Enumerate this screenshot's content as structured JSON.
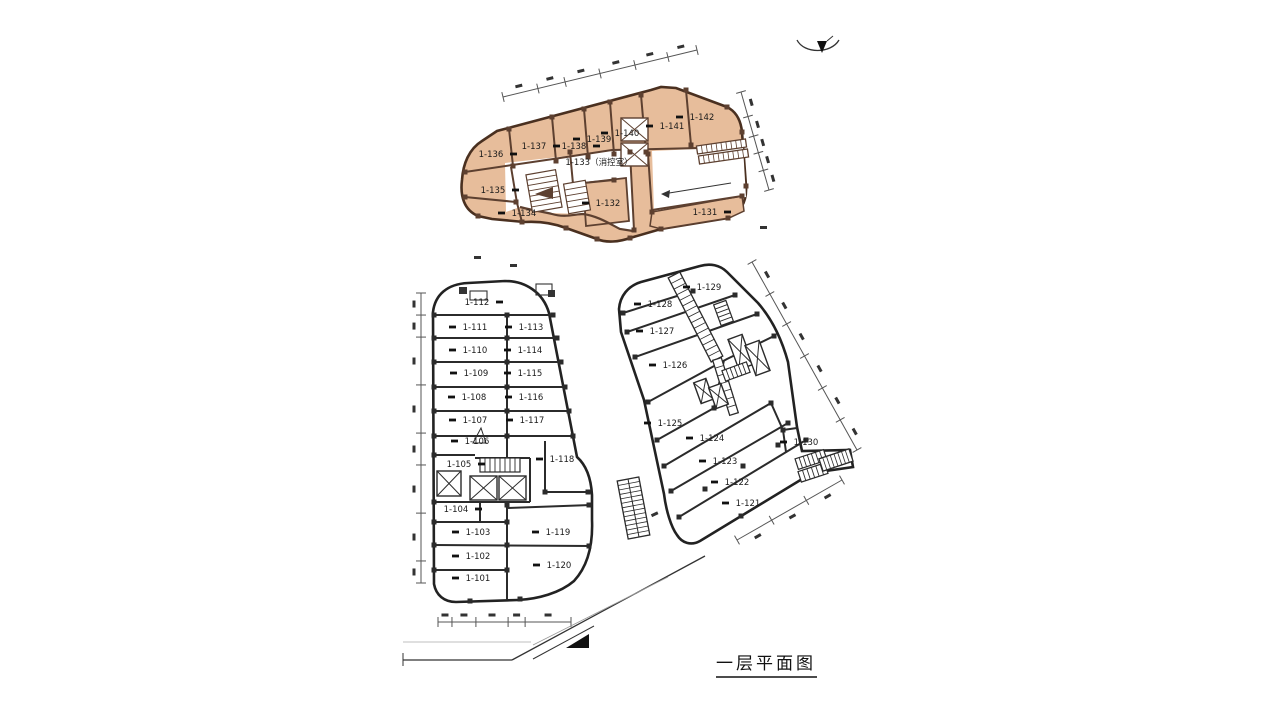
{
  "title": {
    "text": "一层平面图"
  },
  "plan": {
    "highlight_color": "#e7bd9b",
    "highlight_wall_color": "#5d4030",
    "line_color": "#2b2b2b",
    "dimension_color": "#555555",
    "buildings": [
      {
        "id": "upper-highlighted-building",
        "units": [
          {
            "label": "1-131",
            "x": 705,
            "y": 212,
            "dash": "r"
          },
          {
            "label": "1-132",
            "x": 608,
            "y": 203,
            "dash": "l"
          },
          {
            "label": "1-133（消控室）",
            "x": 599,
            "y": 162,
            "dash": "n"
          },
          {
            "label": "1-134",
            "x": 524,
            "y": 213,
            "dash": "l"
          },
          {
            "label": "1-135",
            "x": 493,
            "y": 190,
            "dash": "r"
          },
          {
            "label": "1-136",
            "x": 491,
            "y": 154,
            "dash": "r"
          },
          {
            "label": "1-137",
            "x": 534,
            "y": 146,
            "dash": "r"
          },
          {
            "label": "1-138",
            "x": 574,
            "y": 146,
            "dash": "r"
          },
          {
            "label": "1-139",
            "x": 599,
            "y": 139,
            "dash": "l"
          },
          {
            "label": "1-140",
            "x": 627,
            "y": 133,
            "dash": "l"
          },
          {
            "label": "1-141",
            "x": 672,
            "y": 126,
            "dash": "l"
          },
          {
            "label": "1-142",
            "x": 702,
            "y": 117,
            "dash": "l"
          }
        ]
      },
      {
        "id": "lower-left-building",
        "units": [
          {
            "label": "1-101",
            "x": 478,
            "y": 578,
            "dash": "l"
          },
          {
            "label": "1-102",
            "x": 478,
            "y": 556,
            "dash": "l"
          },
          {
            "label": "1-103",
            "x": 478,
            "y": 532,
            "dash": "l"
          },
          {
            "label": "1-104",
            "x": 456,
            "y": 509,
            "dash": "r"
          },
          {
            "label": "1-105",
            "x": 459,
            "y": 464,
            "dash": "r"
          },
          {
            "label": "1-106",
            "x": 477,
            "y": 441,
            "dash": "l"
          },
          {
            "label": "1-107",
            "x": 475,
            "y": 420,
            "dash": "l"
          },
          {
            "label": "1-108",
            "x": 474,
            "y": 397,
            "dash": "l"
          },
          {
            "label": "1-109",
            "x": 476,
            "y": 373,
            "dash": "l"
          },
          {
            "label": "1-110",
            "x": 475,
            "y": 350,
            "dash": "l"
          },
          {
            "label": "1-111",
            "x": 475,
            "y": 327,
            "dash": "l"
          },
          {
            "label": "1-112",
            "x": 477,
            "y": 302,
            "dash": "r"
          },
          {
            "label": "1-113",
            "x": 531,
            "y": 327,
            "dash": "l"
          },
          {
            "label": "1-114",
            "x": 530,
            "y": 350,
            "dash": "l"
          },
          {
            "label": "1-115",
            "x": 530,
            "y": 373,
            "dash": "l"
          },
          {
            "label": "1-116",
            "x": 531,
            "y": 397,
            "dash": "l"
          },
          {
            "label": "1-117",
            "x": 532,
            "y": 420,
            "dash": "l"
          },
          {
            "label": "1-118",
            "x": 562,
            "y": 459,
            "dash": "l"
          },
          {
            "label": "1-119",
            "x": 558,
            "y": 532,
            "dash": "l"
          },
          {
            "label": "1-120",
            "x": 559,
            "y": 565,
            "dash": "l"
          }
        ]
      },
      {
        "id": "lower-right-building",
        "units": [
          {
            "label": "1-121",
            "x": 748,
            "y": 503,
            "dash": "l"
          },
          {
            "label": "1-122",
            "x": 737,
            "y": 482,
            "dash": "l"
          },
          {
            "label": "1-123",
            "x": 725,
            "y": 461,
            "dash": "l"
          },
          {
            "label": "1-124",
            "x": 712,
            "y": 438,
            "dash": "l"
          },
          {
            "label": "1-125",
            "x": 670,
            "y": 423,
            "dash": "l"
          },
          {
            "label": "1-126",
            "x": 675,
            "y": 365,
            "dash": "l"
          },
          {
            "label": "1-127",
            "x": 662,
            "y": 331,
            "dash": "l"
          },
          {
            "label": "1-128",
            "x": 660,
            "y": 304,
            "dash": "l"
          },
          {
            "label": "1-129",
            "x": 709,
            "y": 287,
            "dash": "l"
          },
          {
            "label": "1-130",
            "x": 806,
            "y": 442,
            "dash": "l"
          }
        ]
      }
    ]
  }
}
